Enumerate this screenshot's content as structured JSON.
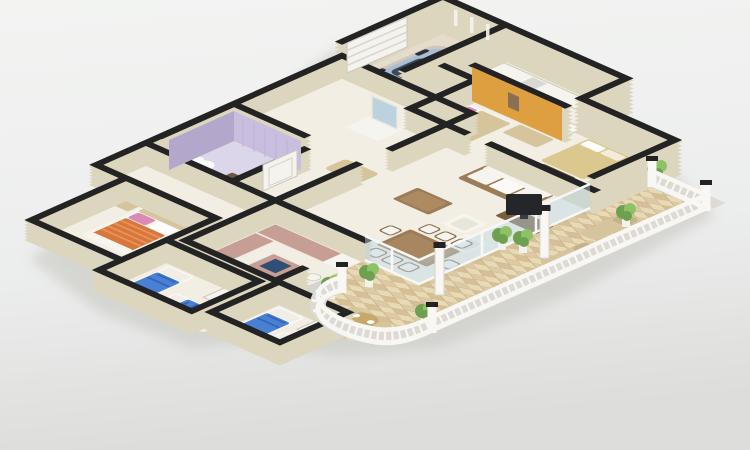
{
  "scene": {
    "kind": "3d-isometric-floorplan-render",
    "rooms": [
      "garage",
      "utility-galley-kitchen",
      "orange-wall-bedroom",
      "tan-bed-bedroom",
      "hallway",
      "lavender-bathroom",
      "master-bedroom",
      "kids-bedroom-left",
      "kids-bedroom-right",
      "kitchen",
      "dining-area",
      "living-room",
      "tiled-terrace",
      "curved-balcony"
    ],
    "furniture": [
      "blue-car",
      "white-sofa",
      "tv-console",
      "coffee-table",
      "armchairs",
      "dining-table-eight-chairs",
      "kitchen-island-with-sink",
      "bar-stools",
      "orange-striped-double-bed",
      "blue-twin-beds",
      "white-wardrobes",
      "tan-double-bed",
      "round-side-table",
      "sun-loungers",
      "balcony-round-table",
      "potted-plants",
      "toilet",
      "shower-mat",
      "vanity-with-mirror",
      "hall-bench",
      "white-columns",
      "balustrade"
    ]
  },
  "palette": {
    "background_top": "#f3f4f2",
    "background_mid": "#eceded",
    "background_bottom": "#dddedb",
    "shadow": "#c7c7c1",
    "wall_face": "#ddd6bf",
    "wall_top": "#232323",
    "floor_main": "#f2eee3",
    "floor_garage": "#e5dccb",
    "floor_bath": "#dcd6ea",
    "tile_base": "#e9dab6",
    "tile_alt": "#ddc9a4",
    "tile_alt2": "#d5bf96",
    "tile_grout": "#c9b48c",
    "balustrade": "#f8f7f3",
    "balustrade_shade": "#dcdad2",
    "lavender_wall": "#c9bede",
    "lavender_wall_dark": "#b4a7cc",
    "orange_wall": "#dd9f3f",
    "door_white": "#f4f3ee",
    "glass": "#bdd8e4",
    "glass_frame": "#f7f8f6",
    "car_body": "#a7bed6",
    "car_glass": "#3c4a58",
    "car_roof": "#9fb6cc",
    "wheel": "#2c3138",
    "bed_blue": "#4a80d4",
    "bed_blue_dark": "#3465b8",
    "blanket_orange": "#d8773c",
    "blanket_stripe": "#e8935c",
    "pillow_pink": "#d98ab5",
    "furniture_white": "#f6f4ee",
    "furniture_tan": "#d5c49c",
    "bed_tan": "#dbc88e",
    "wood": "#9c7c57",
    "wood_dark": "#7b5d40",
    "counter_mauve": "#c69e94",
    "sink_navy": "#2e4f76",
    "plant_green": "#6da150",
    "plant_light": "#8fc268",
    "pot_white": "#f2f1ec",
    "tv_black": "#24262a",
    "mirror_blue": "#bcd3de",
    "toilet_white": "#fafaf8",
    "shower_mat": "#6b5740"
  }
}
